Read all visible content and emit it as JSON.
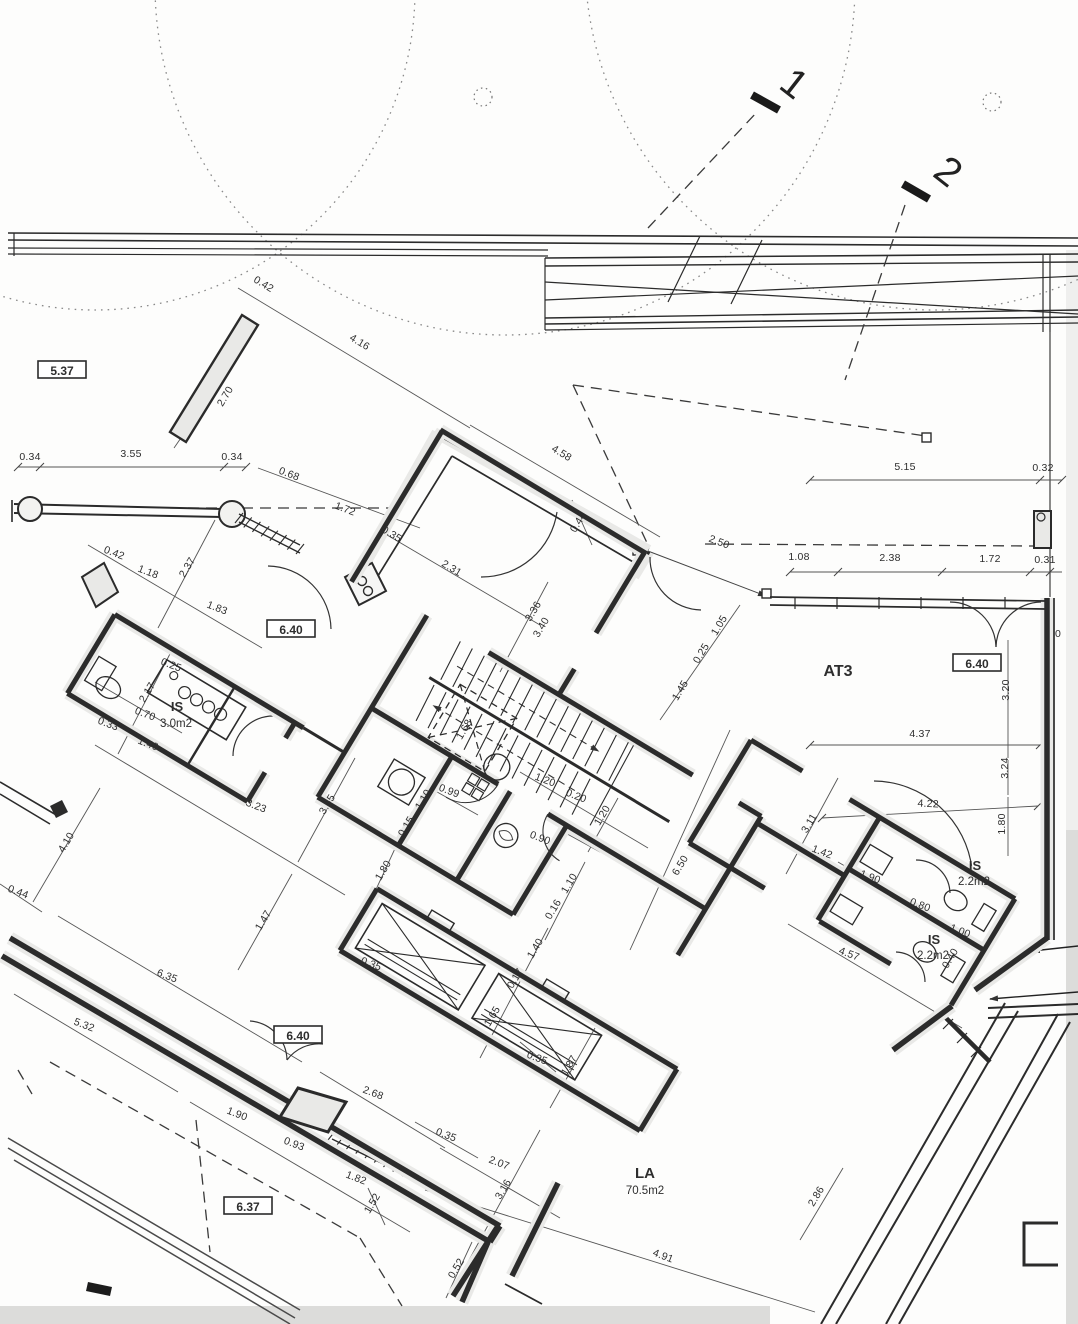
{
  "sheet": {
    "type": "architectural-floor-plan",
    "background": "#fdfdfc",
    "ink": "#2b2b2b",
    "wall_fill": "#e9e9e7"
  },
  "section_markers": [
    {
      "label": "1",
      "x": 786,
      "y": 94,
      "rot": 38
    },
    {
      "label": "2",
      "x": 940,
      "y": 182,
      "rot": 38
    }
  ],
  "boxed_labels": [
    {
      "text": "5.37",
      "x": 62,
      "y": 371
    },
    {
      "text": "6.40",
      "x": 291,
      "y": 630
    },
    {
      "text": "6.40",
      "x": 977,
      "y": 664
    },
    {
      "text": "6.40",
      "x": 298,
      "y": 1036
    },
    {
      "text": "6.37",
      "x": 248,
      "y": 1207
    }
  ],
  "rooms": [
    {
      "name": "IS",
      "area": "3.0m2",
      "x": 177,
      "y": 711,
      "ax": 176,
      "ay": 727,
      "size": 13
    },
    {
      "name": "AT3",
      "area": "",
      "x": 838,
      "y": 676,
      "ax": 0,
      "ay": 0,
      "size": 16
    },
    {
      "name": "IS",
      "area": "2.2m2",
      "x": 975,
      "y": 870,
      "ax": 974,
      "ay": 885,
      "size": 13
    },
    {
      "name": "IS",
      "area": "2.2m2",
      "x": 934,
      "y": 944,
      "ax": 933,
      "ay": 959,
      "size": 13
    },
    {
      "name": "LA",
      "area": "70.5m2",
      "x": 645,
      "y": 1178,
      "ax": 645,
      "ay": 1194,
      "size": 15
    }
  ],
  "dimensions": [
    [
      "0.42",
      262,
      287,
      31
    ],
    [
      "4.16",
      358,
      345,
      31
    ],
    [
      "2.70",
      228,
      398,
      -59
    ],
    [
      "0.34",
      30,
      460,
      0
    ],
    [
      "3.55",
      131,
      457,
      0
    ],
    [
      "0.34",
      232,
      460,
      0
    ],
    [
      "0.68",
      288,
      477,
      21
    ],
    [
      "1.72",
      344,
      512,
      21
    ],
    [
      "0.35",
      390,
      537,
      31
    ],
    [
      "4.58",
      560,
      456,
      31
    ],
    [
      "0.44",
      581,
      524,
      -59
    ],
    [
      "2.31",
      450,
      571,
      31
    ],
    [
      "3.36",
      536,
      613,
      -59
    ],
    [
      "3.40",
      544,
      629,
      -59
    ],
    [
      "2.50",
      718,
      545,
      21
    ],
    [
      "5.15",
      905,
      470,
      0
    ],
    [
      "0.32",
      1043,
      471,
      0
    ],
    [
      "1.08",
      799,
      560,
      0
    ],
    [
      "2.38",
      890,
      561,
      0
    ],
    [
      "1.72",
      990,
      562,
      0
    ],
    [
      "0.31",
      1045,
      563,
      0
    ],
    [
      "1.05",
      722,
      627,
      -59
    ],
    [
      "0.25",
      704,
      655,
      -59
    ],
    [
      "1.45",
      683,
      692,
      -59
    ],
    [
      "1.68",
      467,
      731,
      -59
    ],
    [
      "1.10",
      426,
      801,
      -59
    ],
    [
      "0.99",
      448,
      794,
      21
    ],
    [
      "0.15",
      409,
      828,
      -59
    ],
    [
      "1.80",
      386,
      872,
      -59
    ],
    [
      "1.20",
      544,
      783,
      21
    ],
    [
      "0.20",
      575,
      799,
      21
    ],
    [
      "1.20",
      605,
      817,
      -59
    ],
    [
      "0.90",
      539,
      841,
      21
    ],
    [
      "1.10",
      572,
      885,
      -59
    ],
    [
      "0.16",
      556,
      911,
      -59
    ],
    [
      "6.50",
      683,
      867,
      -59
    ],
    [
      "0.35",
      370,
      967,
      21
    ],
    [
      "0.17",
      518,
      980,
      -59
    ],
    [
      "1.40",
      538,
      950,
      -59
    ],
    [
      "1.65",
      495,
      1018,
      -59
    ],
    [
      "1.87",
      572,
      1067,
      -59
    ],
    [
      "0.35",
      536,
      1061,
      21
    ],
    [
      "0.35",
      445,
      1138,
      21
    ],
    [
      "2.68",
      372,
      1096,
      21
    ],
    [
      "2.07",
      498,
      1166,
      21
    ],
    [
      "3.16",
      506,
      1191,
      -59
    ],
    [
      "0.52",
      459,
      1270,
      -59
    ],
    [
      "4.91",
      662,
      1259,
      21
    ],
    [
      "2.17",
      150,
      694,
      -59
    ],
    [
      "0.25",
      170,
      668,
      21
    ],
    [
      "0.70",
      144,
      717,
      21
    ],
    [
      "1.40",
      147,
      747,
      21
    ],
    [
      "0.33",
      107,
      727,
      21
    ],
    [
      "1.18",
      147,
      575,
      21
    ],
    [
      "2.37",
      190,
      569,
      -59
    ],
    [
      "1.83",
      216,
      611,
      21
    ],
    [
      "0.42",
      113,
      556,
      21
    ],
    [
      "3.23",
      255,
      809,
      21
    ],
    [
      "3.55",
      330,
      806,
      -59
    ],
    [
      "1.47",
      266,
      922,
      -59
    ],
    [
      "4.10",
      69,
      844,
      -59
    ],
    [
      "0.44",
      17,
      895,
      21
    ],
    [
      "6.35",
      166,
      979,
      21
    ],
    [
      "5.32",
      83,
      1028,
      21
    ],
    [
      "1.90",
      236,
      1117,
      21
    ],
    [
      "0.93",
      293,
      1147,
      21
    ],
    [
      "1.82",
      355,
      1181,
      21
    ],
    [
      "1.52",
      375,
      1205,
      -59
    ],
    [
      "4.37",
      920,
      737,
      0
    ],
    [
      "3.20",
      1009,
      690,
      -90
    ],
    [
      "3.24",
      1008,
      768,
      -90
    ],
    [
      "1.80",
      1005,
      824,
      -90
    ],
    [
      "4.22",
      928,
      807,
      3
    ],
    [
      "3.11",
      812,
      825,
      -59
    ],
    [
      "1.42",
      821,
      855,
      21
    ],
    [
      "1.90",
      869,
      880,
      21
    ],
    [
      "0.80",
      919,
      908,
      21
    ],
    [
      "1.00",
      959,
      934,
      21
    ],
    [
      "0.40",
      953,
      960,
      -59
    ],
    [
      "4.57",
      848,
      957,
      21
    ],
    [
      "2.86",
      819,
      1198,
      -59
    ]
  ],
  "stray_text": [
    {
      "text": "0",
      "x": 1058,
      "y": 637
    }
  ]
}
